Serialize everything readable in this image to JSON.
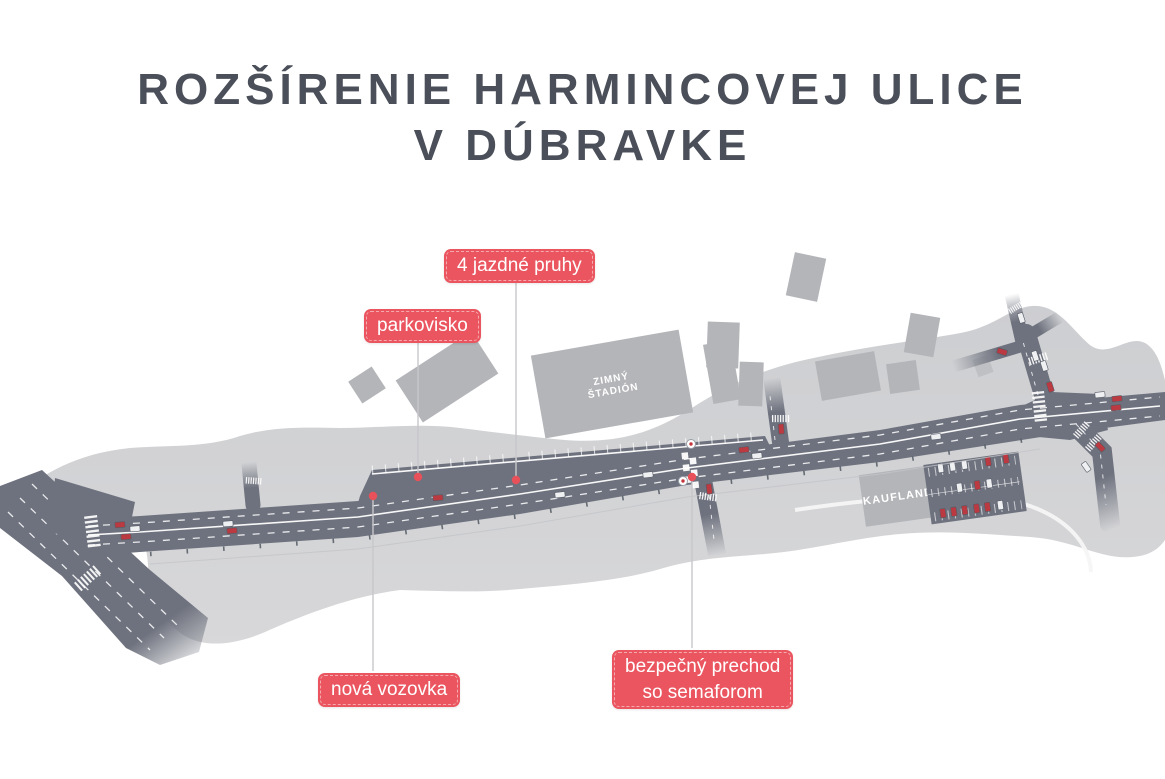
{
  "title": {
    "line1": "ROZŠÍRENIE HARMINCOVEJ ULICE",
    "line2": "V DÚBRAVKE"
  },
  "callouts": {
    "lanes": "4 jazdné pruhy",
    "parking": "parkovisko",
    "new_road": "nová vozovka",
    "crossing_line1": "bezpečný prechod",
    "crossing_line2": "so semaforom"
  },
  "map": {
    "stadium_line1": "ZIMNÝ",
    "stadium_line2": "ŠTADIÓN",
    "kaufland": "KAUFLAND"
  },
  "colors": {
    "accent_red": "#ea555f",
    "title_gray": "#4a4f59",
    "land_gray": "#d2d2d5",
    "building_gray": "#b4b5b9",
    "road_gray": "#6e727e",
    "car_red": "#bb3a41"
  }
}
